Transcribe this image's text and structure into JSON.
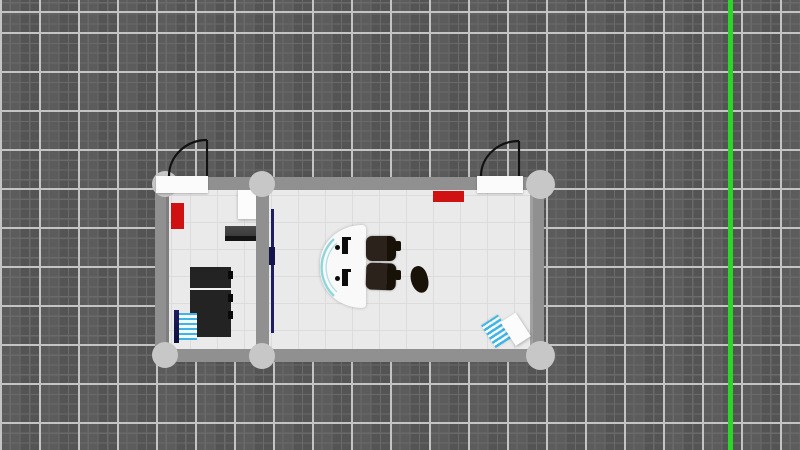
{
  "scene": {
    "description": "top-down simulator viewport of a two-room office floorplan on a dark grid",
    "visible_text": [],
    "rooms": [
      "left-office",
      "right-office"
    ],
    "objects": [
      {
        "name": "world-grid"
      },
      {
        "name": "axis-guide-line",
        "color": "#2bd62b"
      },
      {
        "name": "wall-top"
      },
      {
        "name": "wall-bottom"
      },
      {
        "name": "wall-left"
      },
      {
        "name": "wall-right"
      },
      {
        "name": "wall-divider"
      },
      {
        "name": "wall-joint",
        "count": 6
      },
      {
        "name": "door-left",
        "state": "open-90deg"
      },
      {
        "name": "door-right",
        "state": "open-90deg"
      },
      {
        "name": "red-box-left-wall",
        "color": "#cf1111"
      },
      {
        "name": "red-box-top-wall",
        "color": "#cf1111"
      },
      {
        "name": "white-table"
      },
      {
        "name": "wall-shelf"
      },
      {
        "name": "black-cabinet"
      },
      {
        "name": "ladder-rack",
        "colors": [
          "#1e1e63",
          "#41b4e6"
        ]
      },
      {
        "name": "divider-rail",
        "color": "#1e1e63"
      },
      {
        "name": "reception-desk",
        "accent": "#8fd6da"
      },
      {
        "name": "office-chair",
        "count": 2
      },
      {
        "name": "stray-chair"
      },
      {
        "name": "tilted-cart",
        "colors": [
          "#41b4e6",
          "#fcfcfc"
        ]
      }
    ]
  },
  "colors": {
    "bg": "#575757",
    "gridMinor": "#6a6a6a",
    "gridMajor": "#c4c4c4",
    "wall": "#909090",
    "joint": "#c7c7c7",
    "floor": "#eaeaea",
    "tile": "#dcdcdc",
    "doorLeaf": "#fbfbfb",
    "swing": "#111111",
    "red": "#cf1111",
    "green": "#2bd62b",
    "navy": "#1e1e63",
    "cyan": "#41b4e6",
    "teal": "#8fd6da",
    "cabinet": "#232323",
    "white": "#fcfcfc"
  }
}
